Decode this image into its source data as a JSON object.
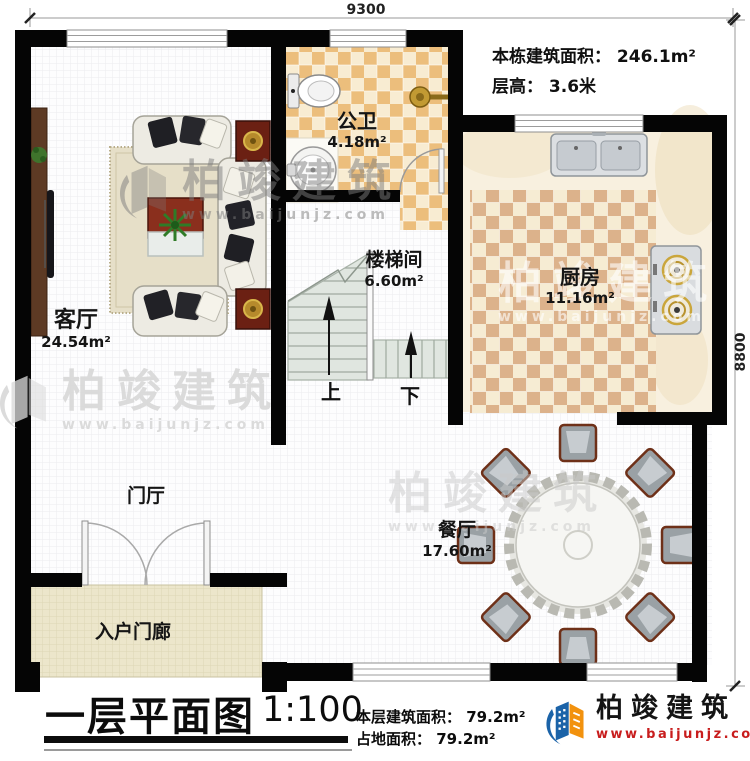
{
  "dimensions": {
    "top_width": "9300",
    "right_height": "8800"
  },
  "building_info": {
    "total_area_label": "本栋建筑面积：",
    "total_area_value": "246.1m²",
    "floor_height_label": "层高：",
    "floor_height_value": "3.6米"
  },
  "rooms": {
    "living_room": {
      "name": "客厅",
      "area": "24.54m²"
    },
    "bathroom": {
      "name": "公卫",
      "area": "4.18m²"
    },
    "kitchen": {
      "name": "厨房",
      "area": "11.16m²"
    },
    "stairwell": {
      "name": "楼梯间",
      "area": "6.60m²"
    },
    "dining_room": {
      "name": "餐厅",
      "area": "17.60m²"
    },
    "foyer": {
      "name": "门厅"
    },
    "entry_porch": {
      "name": "入户门廊"
    }
  },
  "stairs": {
    "up_label": "上",
    "down_label": "下"
  },
  "title_block": {
    "title": "一层平面图",
    "scale": "1:100",
    "floor_area_label": "本层建筑面积：",
    "floor_area_value": "79.2m²",
    "footprint_label": "占地面积：",
    "footprint_value": "79.2m²"
  },
  "brand": {
    "name": "柏竣建筑",
    "website": "www.baijunjz.com"
  },
  "watermark": {
    "text": "柏竣建筑",
    "website": "www.baijunjz.com"
  },
  "colors": {
    "wall": "#000000",
    "bath_tile_dark": "#ecbe7c",
    "bath_tile_light": "#f8ecd2",
    "kitchen_tile_dark": "#dcb28b",
    "kitchen_tile_light": "#f6ecd3",
    "porch_floor": "#ece6cb",
    "brand_blue": "#1b63a8",
    "brand_orange": "#f2920e",
    "website_red": "#c81d1d"
  }
}
